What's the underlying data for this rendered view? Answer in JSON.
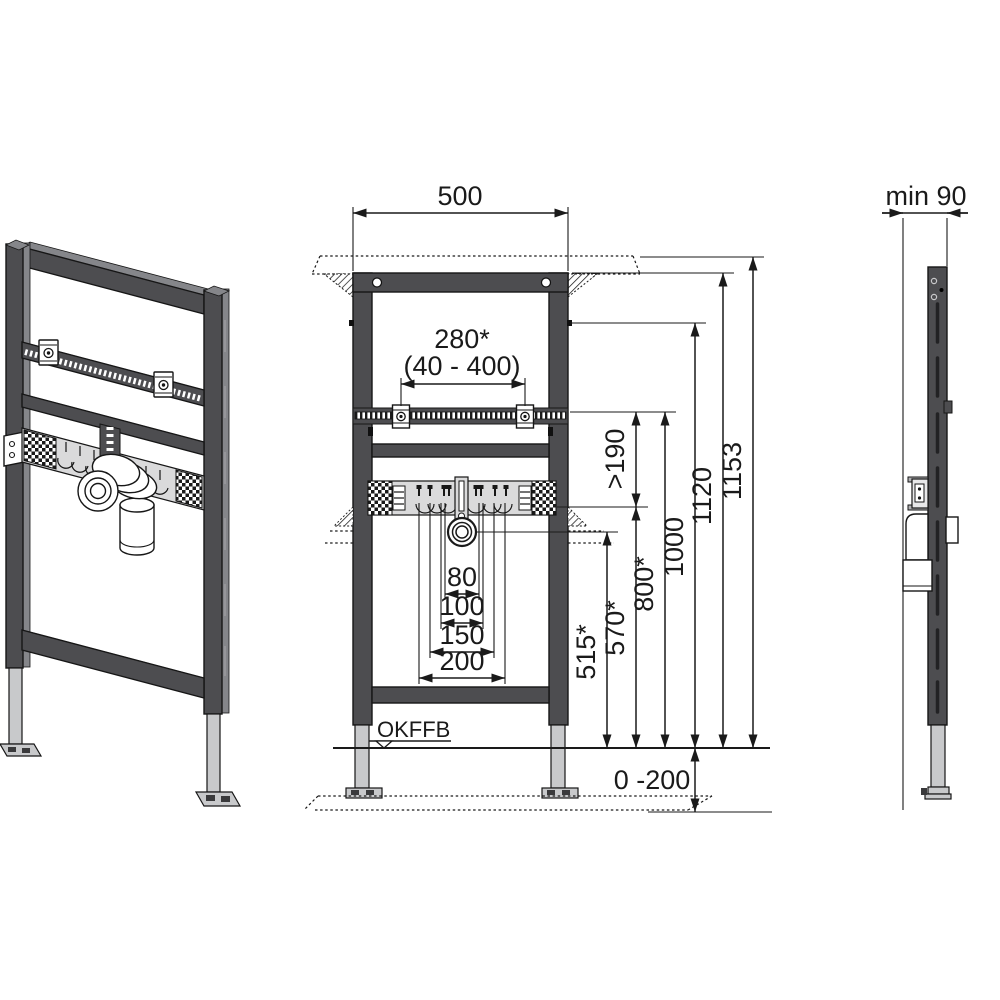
{
  "front_view": {
    "width": "500",
    "bracket_spacing": "280*",
    "bracket_range": "(40 - 400)",
    "drain_offsets": [
      "80",
      "100",
      "150",
      "200"
    ],
    "floor_label": "OKFFB",
    "floor_adjust": "0 -200",
    "heights": {
      "clearance": ">190",
      "drain": "515*",
      "supply": "570*",
      "fixing": "800*",
      "meter": "1000",
      "frame": "1120",
      "total": "1153"
    }
  },
  "side_view": {
    "depth": "min 90"
  },
  "colors": {
    "profile": "#4d4d50",
    "profile_edge": "#85868a",
    "foot": "#c8c9cb",
    "mounting_plate": "#dadadb",
    "line": "#1a1a1a",
    "background": "#ffffff"
  }
}
